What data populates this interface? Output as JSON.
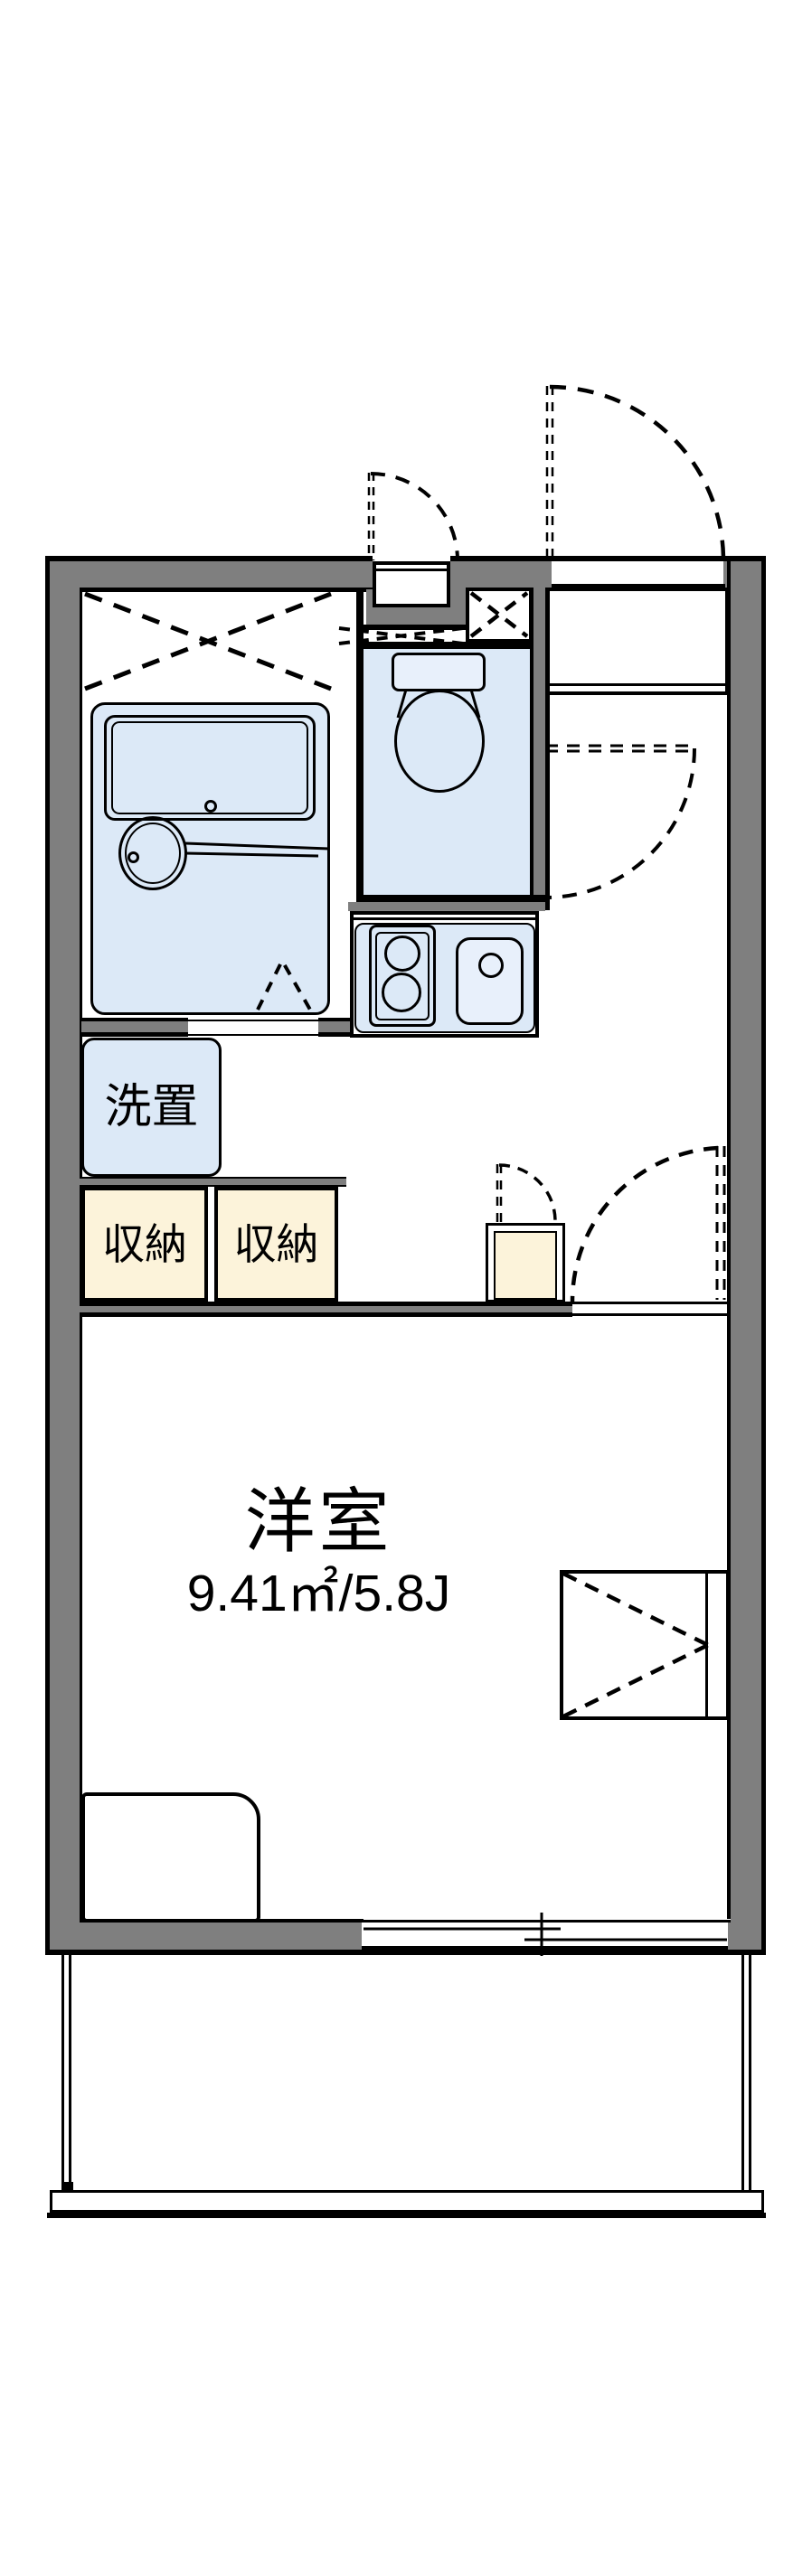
{
  "floorplan": {
    "room": {
      "label": "洋室",
      "area": "9.41㎡/5.8J"
    },
    "washer_label": "洗置",
    "storage_labels": [
      "収納",
      "収納"
    ],
    "colors": {
      "wall": "#7f7f7f",
      "fixture": "#dce9f7",
      "fixture_light": "#e8f0fb",
      "storage": "#fcf3da",
      "line": "#000000",
      "bg": "#ffffff"
    }
  }
}
